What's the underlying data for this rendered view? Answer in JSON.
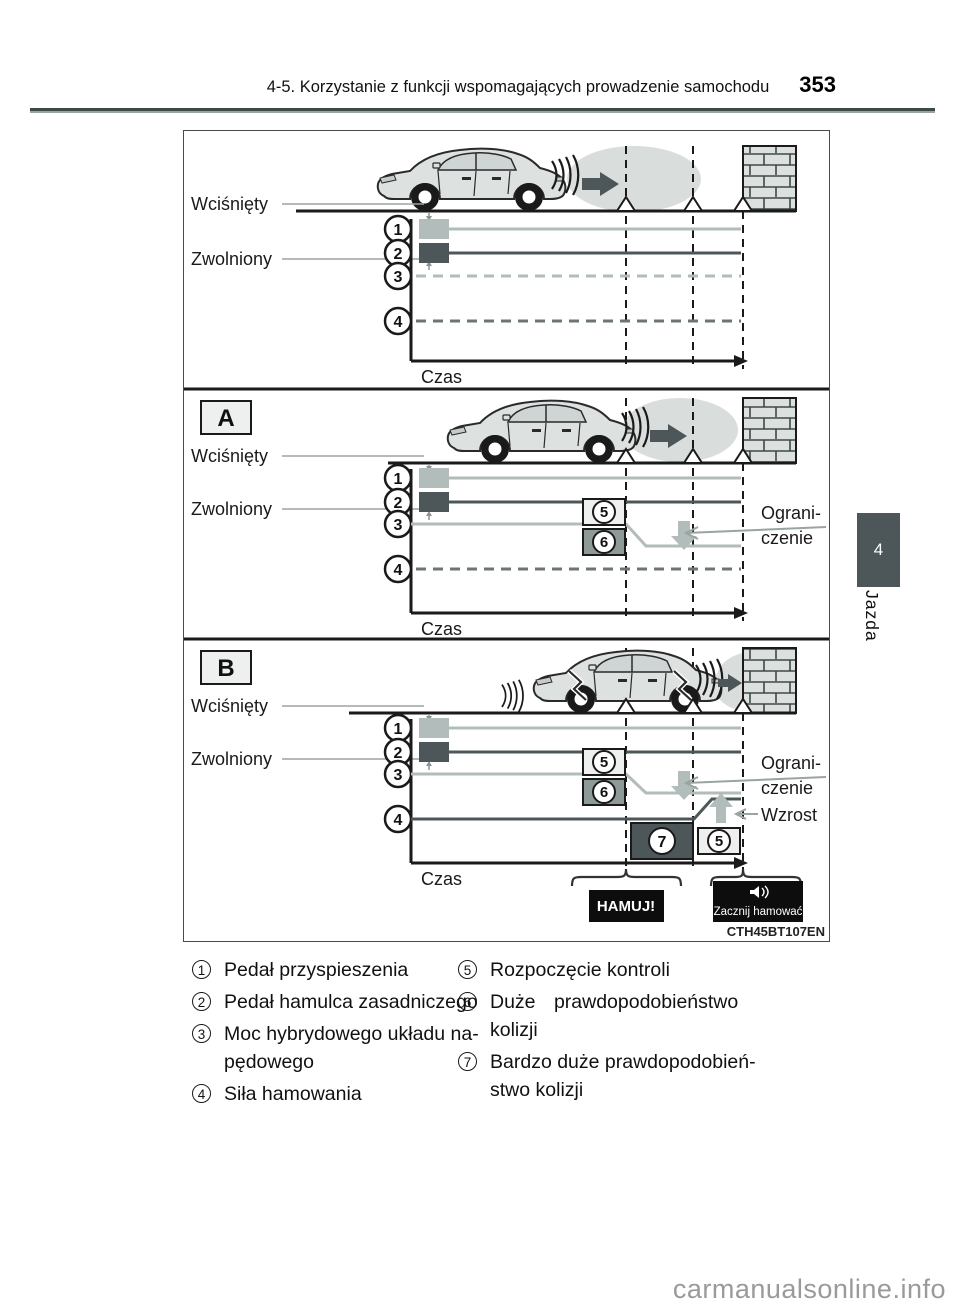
{
  "header": {
    "title": "4-5. Korzystanie z funkcji wspomagających prowadzenie samochodu",
    "page_number": "353"
  },
  "side_tab": {
    "number": "4",
    "label": "Jazda"
  },
  "fig": {
    "code": "CTH45BT107EN",
    "labels": {
      "pressed": "Wciśnięty",
      "released": "Zwolniony",
      "time": "Czas",
      "section_a": "A",
      "section_b": "B",
      "limit1": "Ograni-",
      "limit2": "czenie",
      "increase": "Wzrost",
      "alert": "HAMUJ!",
      "start_braking": "Zacznij hamować"
    },
    "markers": {
      "one": "1",
      "two": "2",
      "three": "3",
      "four": "4",
      "five": "5",
      "six": "6",
      "seven": "7"
    }
  },
  "legend": {
    "items": [
      {
        "num": "1",
        "lines": [
          "Pedał przyspieszenia"
        ]
      },
      {
        "num": "2",
        "lines": [
          "Pedał hamulca zasadniczego"
        ]
      },
      {
        "num": "3",
        "lines": [
          "Moc hybrydowego układu na-",
          "pędowego"
        ]
      },
      {
        "num": "4",
        "lines": [
          "Siła hamowania"
        ]
      },
      {
        "num": "5",
        "lines": [
          "Rozpoczęcie kontroli"
        ]
      },
      {
        "num": "6",
        "lines": [
          "Duże prawdopodobieństwo",
          "kolizji"
        ]
      },
      {
        "num": "7",
        "lines": [
          "Bardzo duże prawdopodobień-",
          "stwo kolizji"
        ]
      }
    ]
  },
  "watermark": "carmanualsonline.info",
  "colors": {
    "dark_gray": "#4d5759",
    "light_gray": "#b2bcba",
    "box_light": "#eef0ef",
    "box_mid": "#8e9a97",
    "cloud": "#d9dedd",
    "tab": "#4d5759"
  }
}
